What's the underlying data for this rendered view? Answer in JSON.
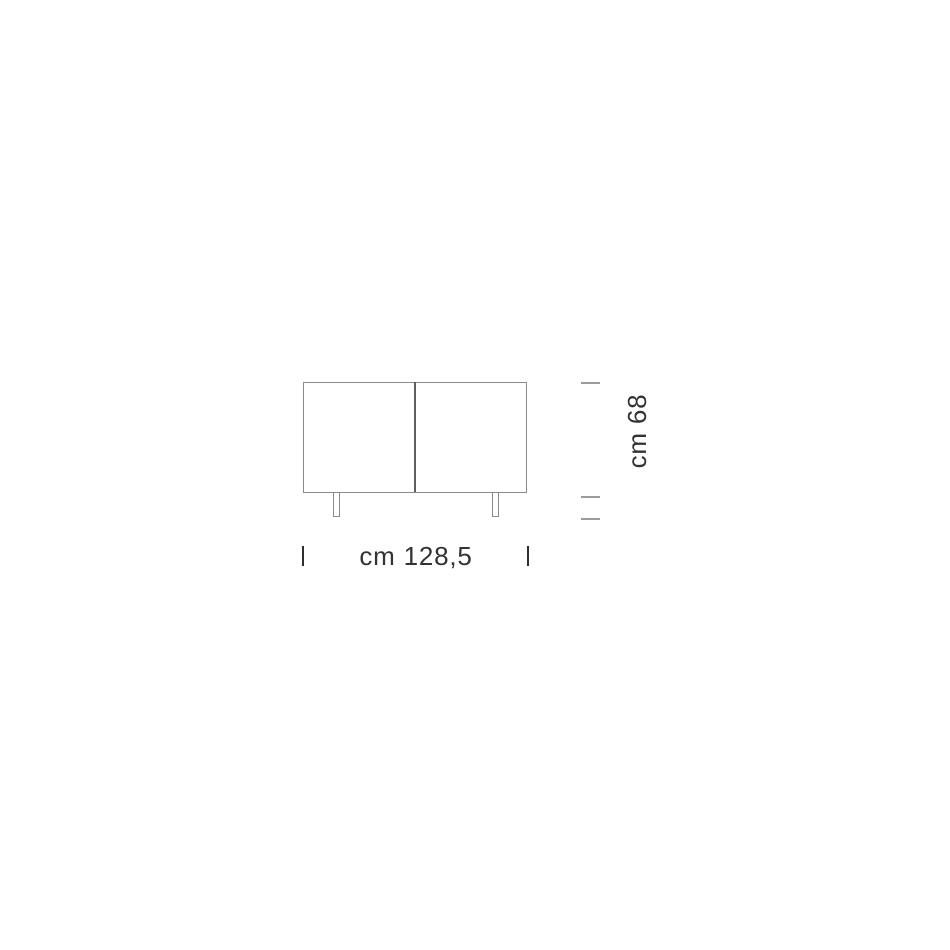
{
  "diagram": {
    "title": "sideboard dimension drawing",
    "width_dimension": {
      "label": "cm 128,5",
      "unit": "cm",
      "value": 128.5
    },
    "height_dimension": {
      "label": "cm 68",
      "unit": "cm",
      "value": 68
    },
    "colors": {
      "background": "#ffffff",
      "outline": "#8a8a8a",
      "divider": "#5f5f5f",
      "tick_gray": "#9a9a9a",
      "tick_dark": "#2f2f2f",
      "text": "#333333"
    }
  }
}
